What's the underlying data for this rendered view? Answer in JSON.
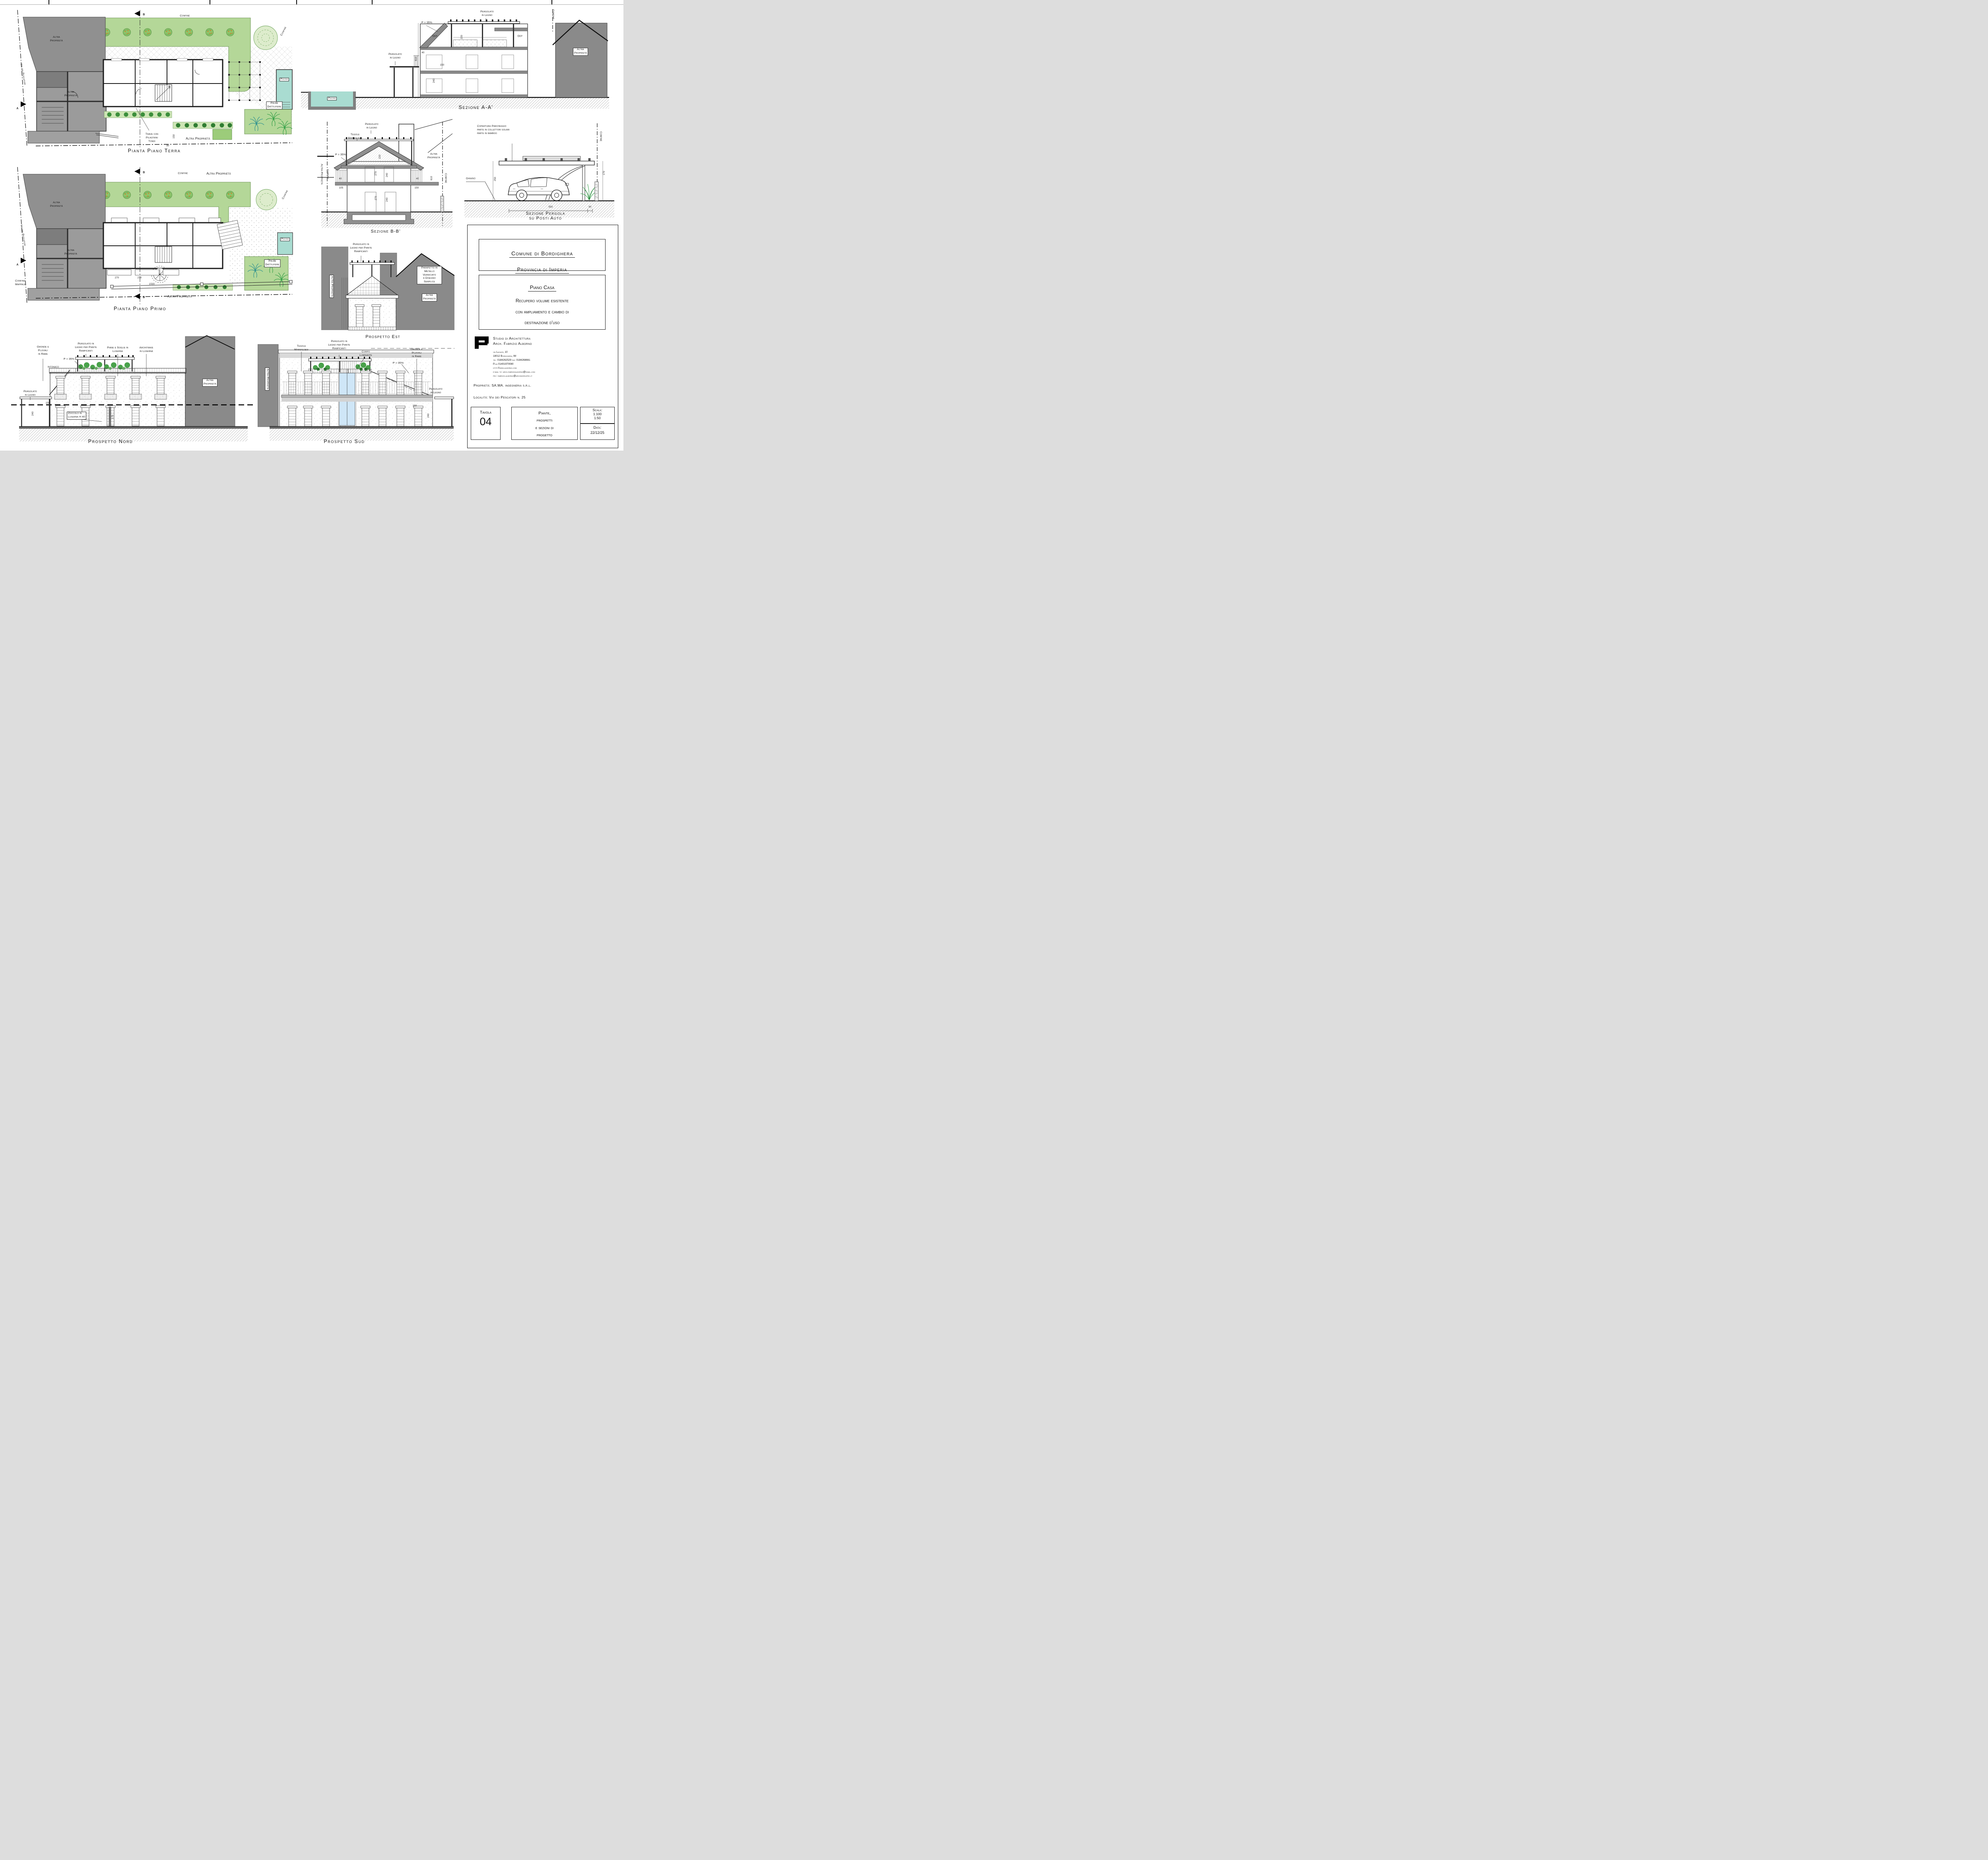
{
  "common": {
    "altra_proprieta": "Altra\nProprietà",
    "altra_proprieta_1l": "Altra Proprietà",
    "confine": "Confine",
    "via_dei_pescatori": "Via dei Pescatori",
    "pergolato_in_legno": "Pergolato\nin Legno",
    "pergolato_rampicanti": "Pergolato in\nLegno per Piante\nRampicanti",
    "p35": "P = 35%",
    "piscina": "Piscina",
    "palme_dattilifere": "Palme\nDattilifere",
    "tegole_marsigliesi": "Tegole\nMarsigliesi",
    "gronde_pluviali": "Gronde e\nPluviali\nin Rame",
    "dep": "Dep",
    "section_a": "A",
    "section_b": "B"
  },
  "dims": {
    "d40": "40",
    "d80": "80",
    "d90": "90",
    "d105": "105",
    "d150": "150",
    "d170": "170",
    "d220": "220",
    "d240": "240",
    "d250": "250",
    "d270": "270",
    "d550": "550",
    "d610": "610",
    "d1530": "1530"
  },
  "panels": {
    "terra": {
      "title": "Pianta Piano Terra",
      "trave": "Trave con\nPilastrini\nTondi"
    },
    "primo": {
      "title": "Pianta Piano Primo",
      "confine_mappale": "Confine\nMappale"
    },
    "sez_a": {
      "title": "Sezione A-A'"
    },
    "sez_b": {
      "title": "Sezione B-B'"
    },
    "sez_pergola": {
      "title": "Sezione Pergola\nsu Posti Auto",
      "copertura": "Copertura Parcheggio\nparte in collettori solari\nparte in bamboo",
      "ghiaino": "Ghiaino"
    },
    "est": {
      "title": "Prospetto Est",
      "parapetto": "Parapetto in\nMetallo Verniciato\na Disegno Semplice"
    },
    "nord": {
      "title": "Prospetto Nord",
      "piane": "Piane e Soglie in\nLuserna",
      "architrave": "Architrave\nin Luserna",
      "intonaco": "Intonaco",
      "zoccolo": "Zoccolo in\nLuserna H 40"
    },
    "sud": {
      "title": "Prospetto Sud",
      "corpo": "Corpo\nLuminante"
    }
  },
  "title_block": {
    "comune": "Comune di Bordighera",
    "provincia": "Provincia di Imperia",
    "piano_casa": "Piano Casa",
    "desc1": "Recupero volume esistente",
    "desc2": "con ampliamento e cambio di",
    "desc3": "destinazione d'uso",
    "studio1": "Studio di Architettura",
    "studio2": "Arch. Fabrizio Alborno",
    "addr1": "via Lagazzi, 10",
    "addr2": "18012 Bordighera, IM",
    "addr3": "tel: 0184262529 fax: 0184268661",
    "addr4": "P.iva 01401970080",
    "addr5": "http://www.alborno.com",
    "addr6": "e-mail to: arch.fabrizioalborno@gmail.com",
    "addr7": "pec: fabrizio.alborno@archiworldpec.it",
    "proprieta": "Proprietà: SA.MA. ingegneria s.r.l.",
    "localita": "Località: Via dei Pescatori n. 25",
    "tavola_label": "Tavola",
    "tavola_num": "04",
    "content": "Piante,\nprospetti\ne sezioni di\nprogetto",
    "scala_label": "Scala:",
    "scala1": "1:100",
    "scala2": "1:50",
    "data_label": "Data:",
    "data_value": "22/12/25"
  },
  "colors": {
    "garden_green": "#b4d798",
    "pool_teal": "#a9dcd1",
    "mass_gray": "#8f8f8f",
    "glass_blue": "#cfe6f7",
    "tree_orange": "#e0761f",
    "palm_teal": "#2a8f8f",
    "palm_green": "#2f9e44"
  }
}
